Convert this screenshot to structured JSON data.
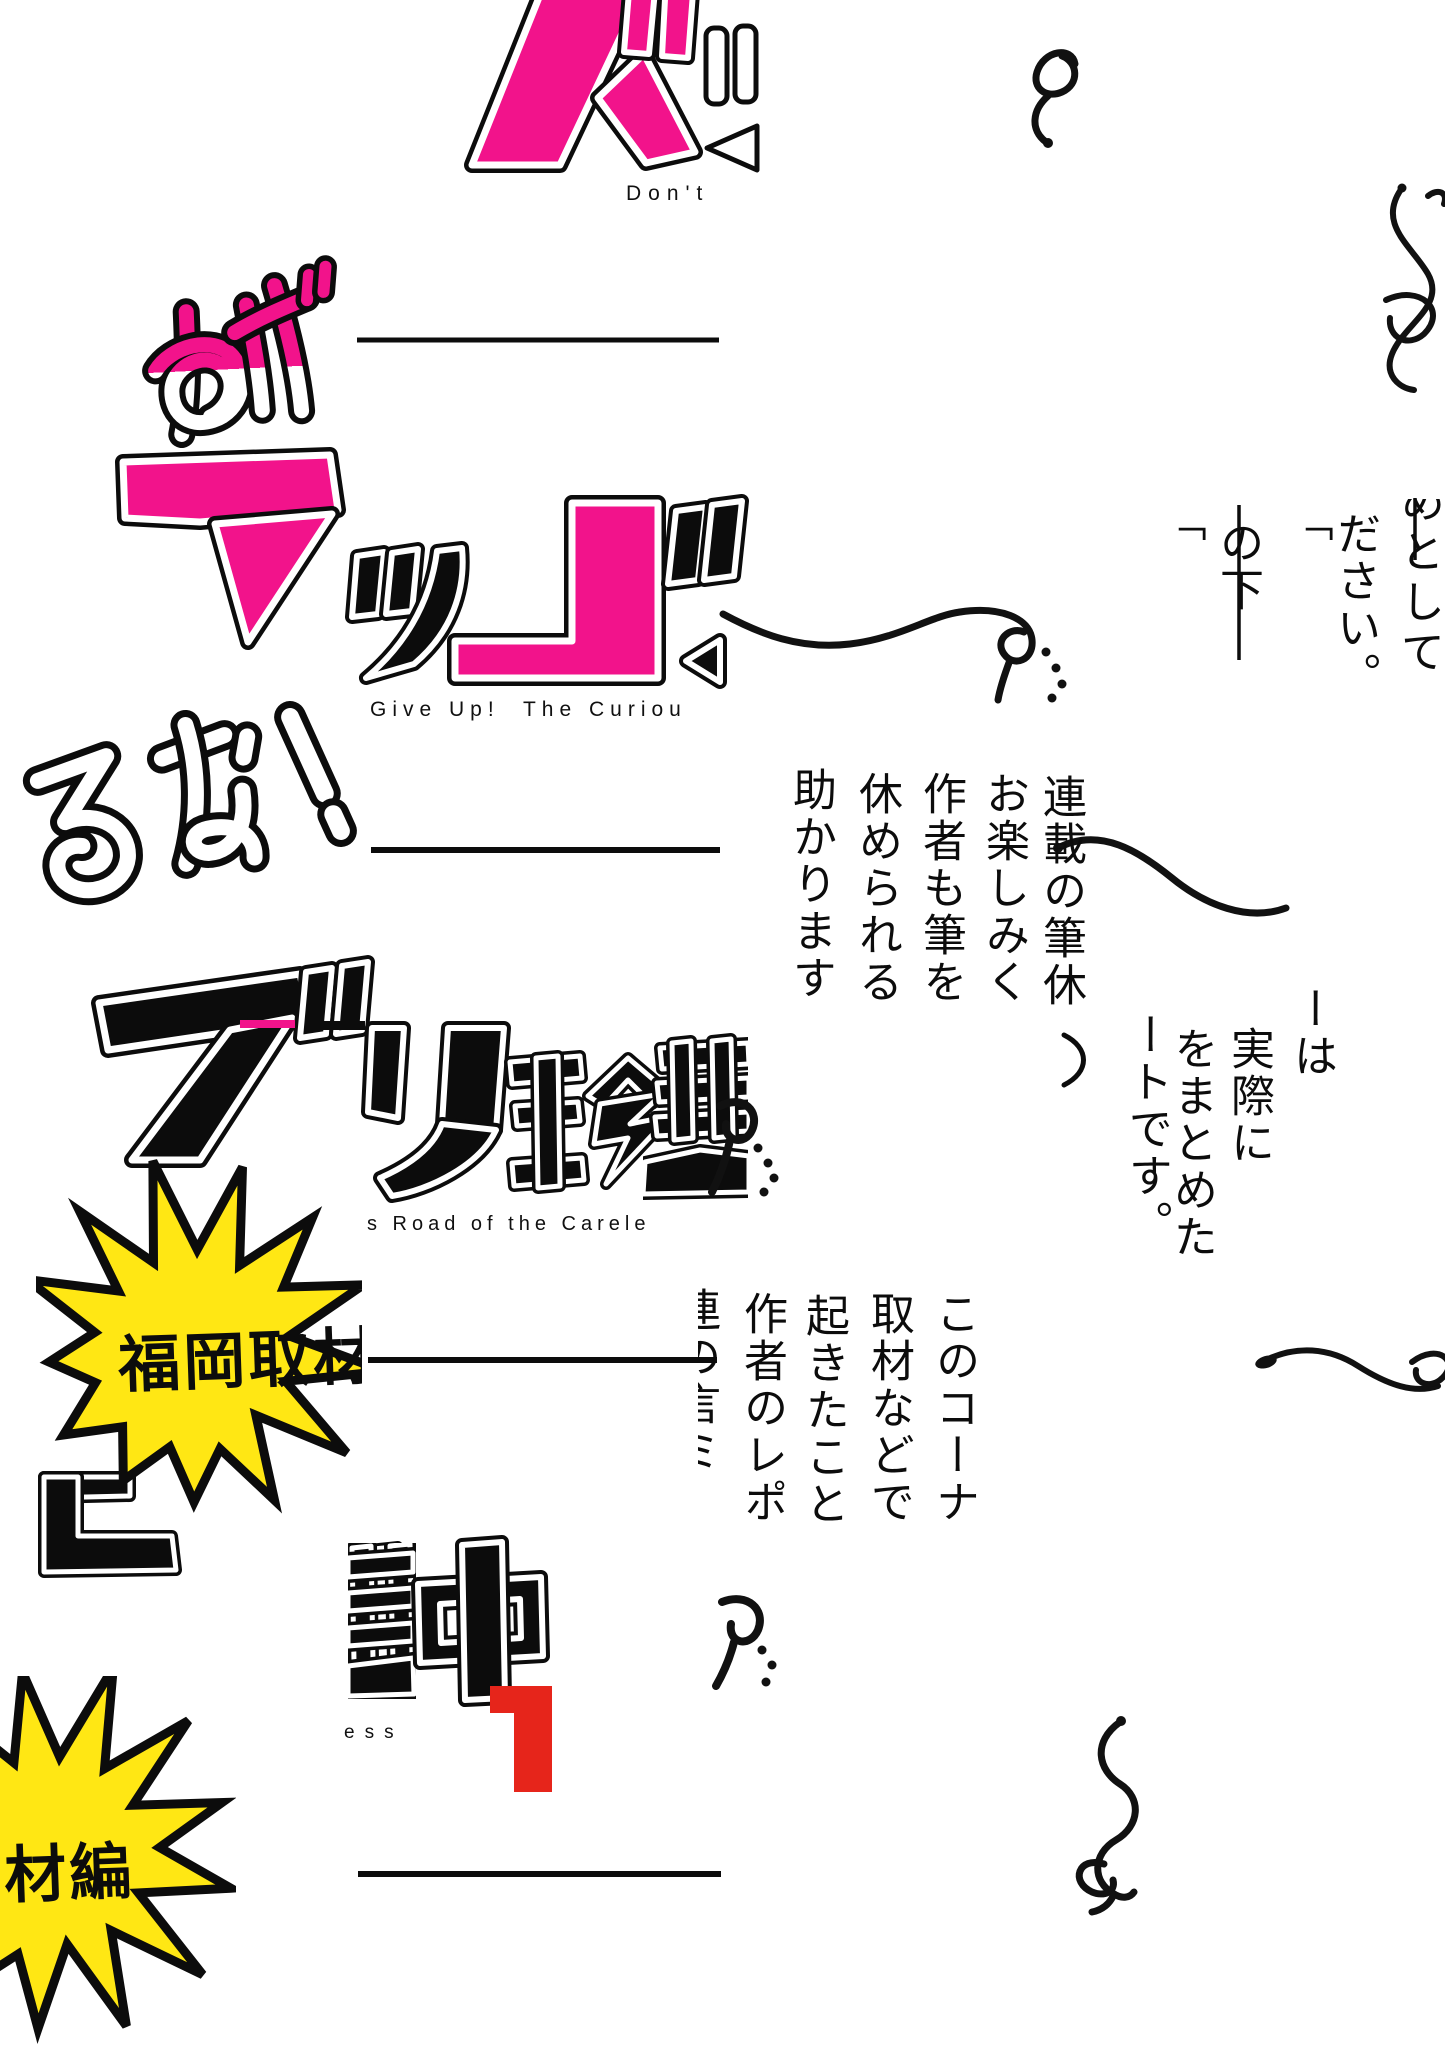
{
  "canvas": {
    "width": 1445,
    "height": 2048,
    "background": "#ffffff"
  },
  "palette": {
    "pink": "#F2138B",
    "yellow": "#FFE714",
    "red": "#E6251B",
    "ink": "#0C0C0C"
  },
  "artwork": {
    "title_japanese": "めげるな！ズボラ珍道中",
    "title_english": "Don't Give Up! The Curious Road of the Careless",
    "volume_number": "1",
    "kana_fragments": {
      "zu": "ズ",
      "mege": "めげ",
      "runa": "るな！",
      "black_cluster": "ブリ珍道",
      "bottom_cluster": "道中"
    }
  },
  "subtitle_fragments": {
    "top": "Don't",
    "middle": "Give Up!  The Curiou",
    "lower": "s Road of the Carele",
    "bottom": "ess"
  },
  "badge": {
    "full_text": "福岡取材編",
    "left_fragment": "福岡取材",
    "right_fragment": "材編"
  },
  "vertical_text": {
    "top_right": {
      "col1": "めとして",
      "col2": "ださい。",
      "col3": "の下",
      "quote_a": "「",
      "quote_b": "「"
    },
    "center": {
      "col1": "連載の筆休",
      "col2": "お楽しみく",
      "col3": "作者も筆を",
      "col4": "休められる",
      "col5": "助かります"
    },
    "mid_right": {
      "col1": "ーは",
      "col2": "実際に",
      "col3": "をまとめた",
      "col4": "ートです。",
      "paren": "）"
    },
    "bottom_center": {
      "col1": "このコーナ",
      "col2": "取材などで",
      "col3": "起きたこと",
      "col4": "作者のレポ",
      "partial": "連の言ミ"
    }
  }
}
